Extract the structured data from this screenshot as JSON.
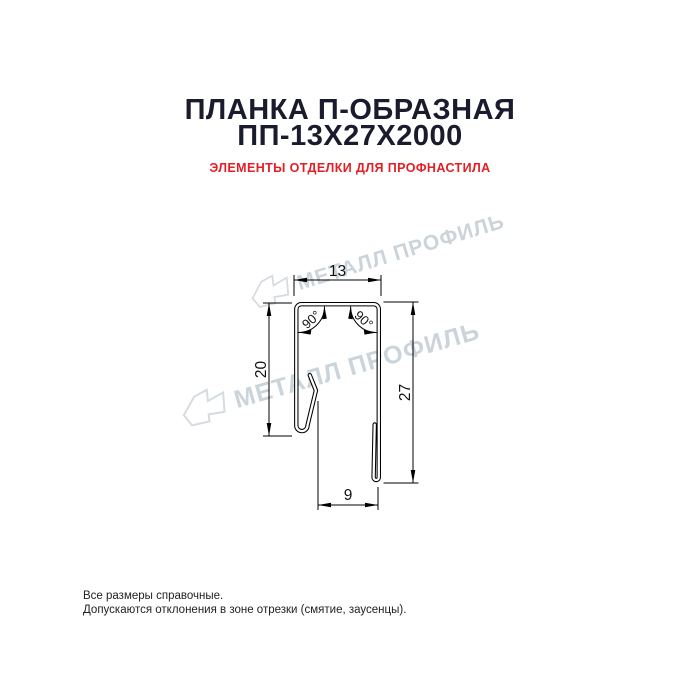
{
  "header": {
    "title_line1": "ПЛАНКА П-ОБРАЗНАЯ",
    "title_line2": "ПП-13Х27Х2000",
    "subtitle": "ЭЛЕМЕНТЫ ОТДЕЛКИ ДЛЯ ПРОФНАСТИЛА"
  },
  "drawing": {
    "dimensions": {
      "top_width": "13",
      "left_height": "20",
      "right_height": "27",
      "bottom_width": "9"
    },
    "angles": {
      "left": "90°",
      "right": "90°"
    }
  },
  "watermark": {
    "text": "МЕТАЛЛ ПРОФИЛЬ",
    "icon": "metall-profil-logo-icon"
  },
  "footer": {
    "line1": "Все размеры справочные.",
    "line2": "Допускаются отклонения в зоне отрезки (смятие, заусенцы)."
  },
  "colors": {
    "title": "#1b1b2e",
    "subtitle_accent": "#e31e24",
    "drawing_lines": "#000000",
    "watermark": "#ccd4db",
    "background": "#ffffff"
  }
}
